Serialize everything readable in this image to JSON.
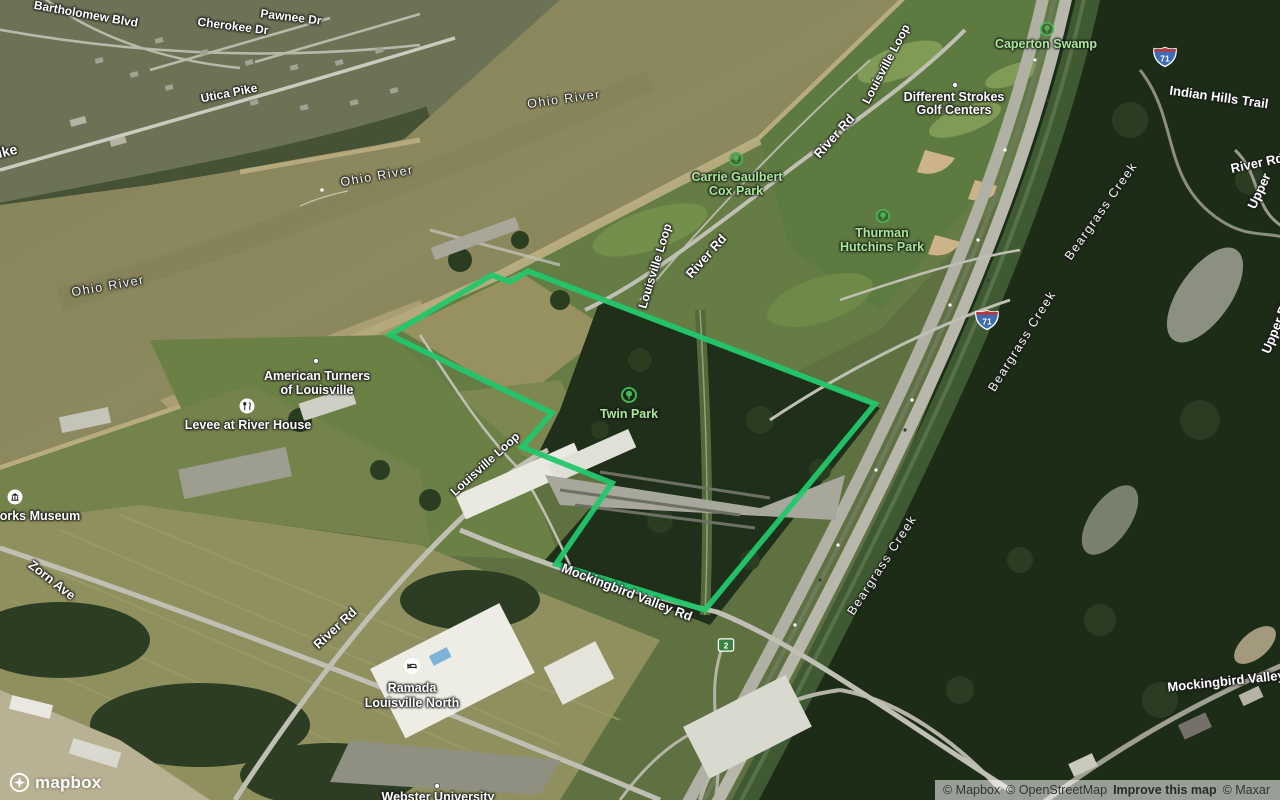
{
  "map": {
    "streets": {
      "bartholomew_blvd": "Bartholomew Blvd",
      "cherokee_dr": "Cherokee Dr",
      "pawnee_dr": "Pawnee Dr",
      "utica_pike": "Utica Pike",
      "pike_clipped": "Pike",
      "zorn_ave": "Zorn Ave",
      "river_rd": "River Rd",
      "upper": "Upper",
      "upper_river_rd": "Upper River Rd",
      "indian_hills_trail": "Indian Hills Trail",
      "louisville_loop": "Louisville Loop",
      "mockingbird_valley_rd": "Mockingbird Valley Rd",
      "mockingbird_valley": "Mockingbird Valley"
    },
    "water": {
      "ohio_river": "Ohio River",
      "beargrass_creek": "Beargrass Creek"
    },
    "parks": {
      "caperton": "Caperton Swamp",
      "cox_line1": "Carrie Gaulbert",
      "cox_line2": "Cox Park",
      "thurman_line1": "Thurman",
      "thurman_line2": "Hutchins Park",
      "twin": "Twin Park"
    },
    "pois": {
      "golf_line1": "Different Strokes",
      "golf_line2": "Golf Centers",
      "turners_line1": "American Turners",
      "turners_line2": "of Louisville",
      "levee": "Levee at River House",
      "museum": "orks Museum",
      "ramada_line1": "Ramada",
      "ramada_line2": "Louisville North",
      "webster": "Webster University"
    },
    "shields": {
      "interstate_71": "71",
      "route_2": "2"
    }
  },
  "branding": {
    "logo_text": "mapbox"
  },
  "attribution": {
    "mapbox": "© Mapbox",
    "osm": "© OpenStreetMap",
    "improve": "Improve this map",
    "maxar": "© Maxar"
  },
  "colors": {
    "parcel_outline": "#22c76b",
    "park_label": "#a7e795",
    "park_icon": "#46b653",
    "interstate_blue": "#3d6cb4",
    "interstate_red": "#b23b3f",
    "route_green": "#38813f"
  }
}
